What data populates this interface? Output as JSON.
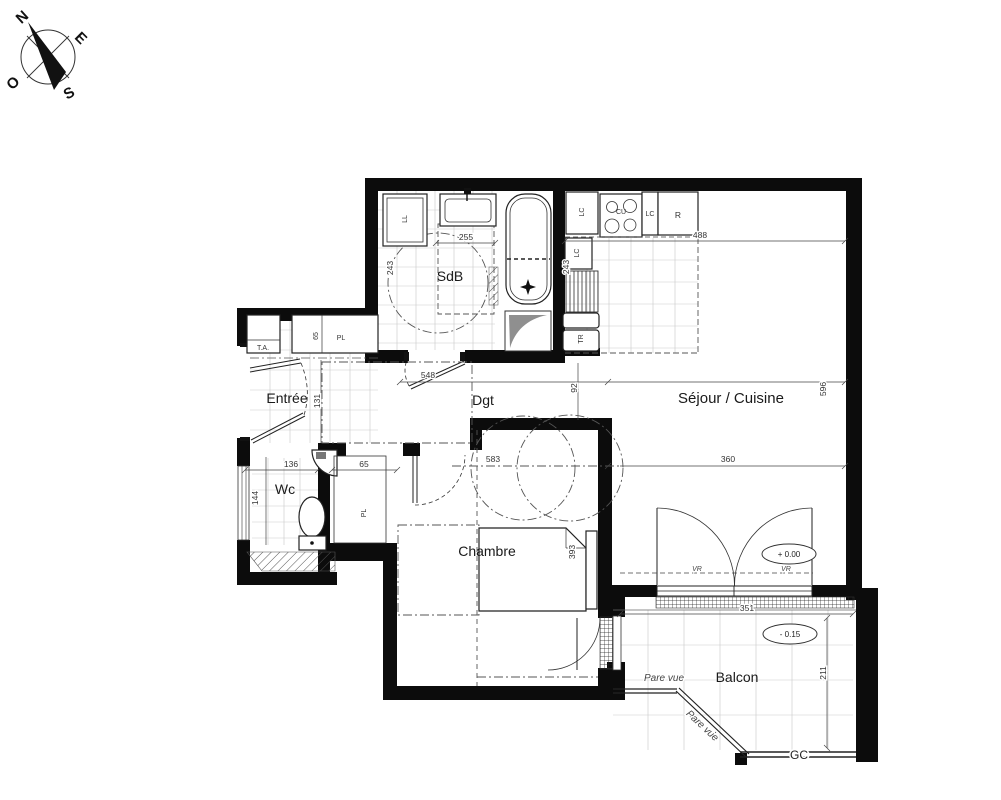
{
  "compass": {
    "north": "N",
    "east": "E",
    "south": "S",
    "west": "O"
  },
  "rooms": {
    "entree": "Entrée",
    "sdb": "SdB",
    "dgt": "Dgt",
    "sejour_cuisine": "Séjour / Cuisine",
    "wc": "Wc",
    "chambre": "Chambre",
    "balcon": "Balcon"
  },
  "labels": {
    "washing_machine": "LL",
    "electrical_panel": "T.A.",
    "closet_entree": "PL",
    "closet_wc": "PL",
    "lc_top": "LC",
    "cooktop": "CU",
    "lc_mid": "LC",
    "fridge": "R",
    "lc_low": "LC",
    "tr": "TR",
    "shutter_left": "VR",
    "shutter_right": "VR",
    "guardrail": "GC",
    "pare_vue_horizontal": "Pare vue",
    "pare_vue_diagonal": "Pare vue"
  },
  "dims": {
    "sdb_width": "255",
    "sdb_depth": "243",
    "kitchen_width": "488",
    "kitchen_depth": "243",
    "entree_width": "136",
    "entree_depth": "131",
    "closet_entree_width": "65",
    "wc_depth": "144",
    "closet_wc_width": "65",
    "dgt_width": "548",
    "dgt_depth": "92",
    "chambre_width": "583",
    "chambre_depth": "393",
    "sejour_width": "360",
    "sejour_depth": "596",
    "balcon_width": "351",
    "balcon_depth": "211"
  },
  "levels": {
    "sejour": "+ 0.00",
    "balcon": "- 0.15"
  }
}
